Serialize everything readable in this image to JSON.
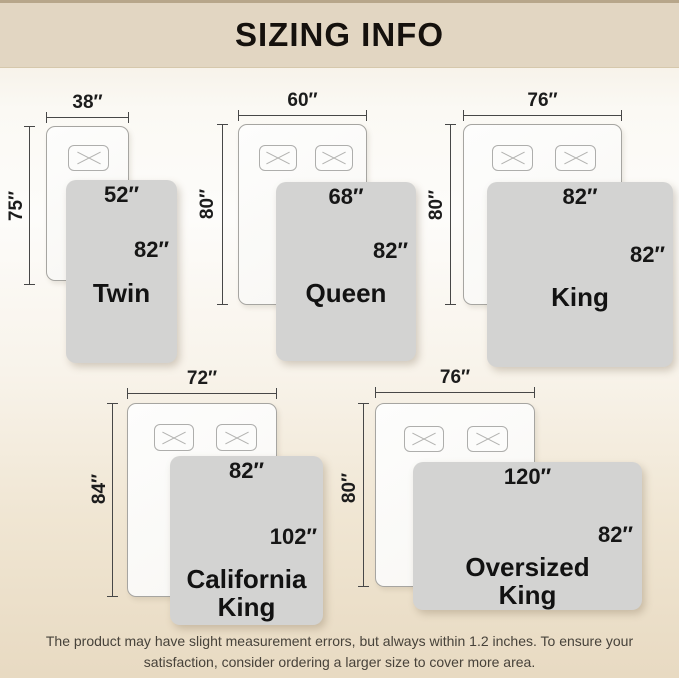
{
  "header": {
    "title": "SIZING INFO"
  },
  "sizes": [
    {
      "id": "twin",
      "name": "Twin",
      "mattress_width": "38″",
      "mattress_length": "75″",
      "blanket_width": "52″",
      "blanket_length": "82″",
      "pillows": 1
    },
    {
      "id": "queen",
      "name": "Queen",
      "mattress_width": "60″",
      "mattress_length": "80″",
      "blanket_width": "68″",
      "blanket_length": "82″",
      "pillows": 2
    },
    {
      "id": "king",
      "name": "King",
      "mattress_width": "76″",
      "mattress_length": "80″",
      "blanket_width": "82″",
      "blanket_length": "82″",
      "pillows": 2
    },
    {
      "id": "california-king",
      "name": "California King",
      "mattress_width": "72″",
      "mattress_length": "84″",
      "blanket_width": "82″",
      "blanket_length": "102″",
      "pillows": 2
    },
    {
      "id": "oversized-king",
      "name": "Oversized King",
      "mattress_width": "76″",
      "mattress_length": "80″",
      "blanket_width": "120″",
      "blanket_length": "82″",
      "pillows": 2
    }
  ],
  "footer": {
    "note_lines": [
      "The product may have slight measurement errors, but always within 1.2 inches. To ensure your",
      "satisfaction, consider ordering a larger size to cover more area."
    ]
  },
  "colors": {
    "header_bg": "#e2d6c2",
    "header_top_line": "#b7a68a",
    "page_bottom_tint": "#e8dac2",
    "blanket_gray": "#d3d3d2",
    "text": "#1a1a1a"
  }
}
